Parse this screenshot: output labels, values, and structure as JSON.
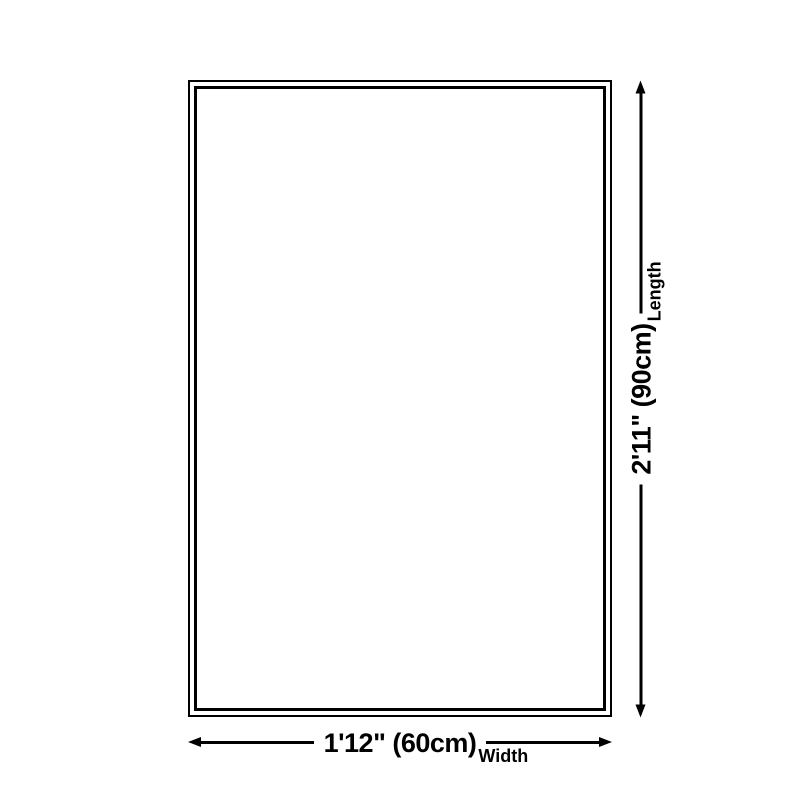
{
  "diagram": {
    "type": "product-dimension-diagram",
    "colors": {
      "background": "#ffffff",
      "line": "#000000",
      "text": "#000000"
    },
    "product_outline": {
      "shape": "rectangle",
      "border_style": "double"
    },
    "width_dimension": {
      "value": "1'12\" (60cm)",
      "label": "Width"
    },
    "length_dimension": {
      "value": "2'11\" (90cm)",
      "label": "Length"
    }
  }
}
